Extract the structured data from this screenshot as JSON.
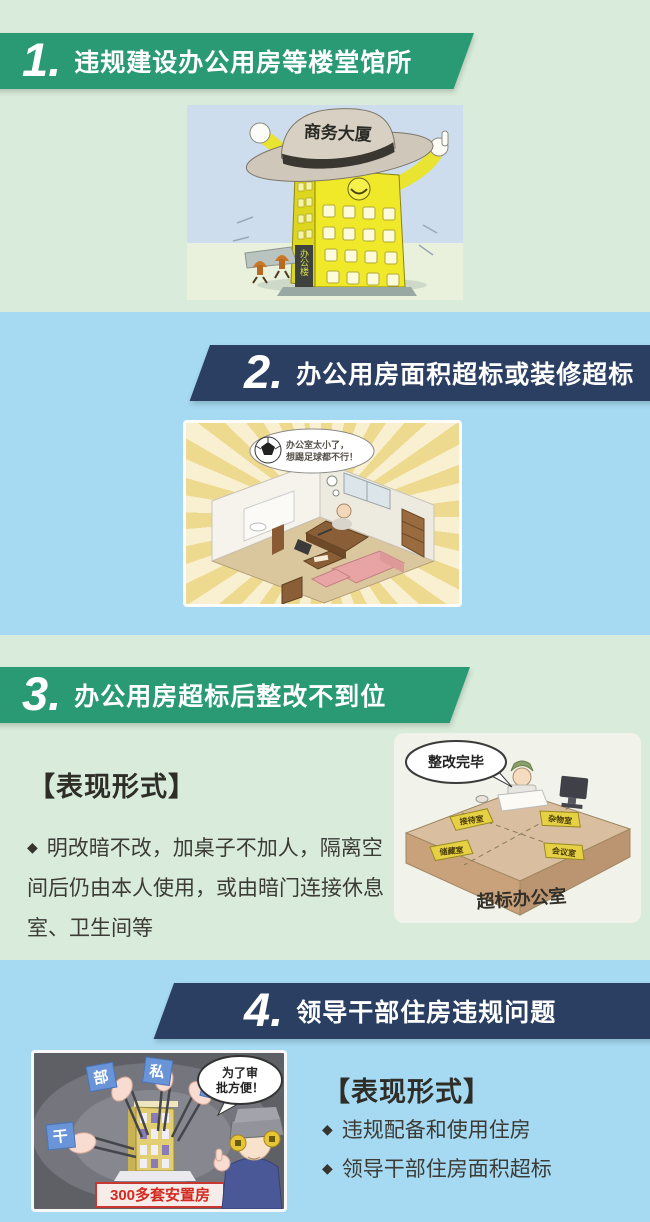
{
  "colors": {
    "banner_green": "#2a9a74",
    "banner_navy": "#2b3f63",
    "bg_green": "#d9ecdb",
    "bg_blue": "#a6daf2",
    "heading_text": "#2e2d28",
    "red_accent": "#d42a20"
  },
  "sections": [
    {
      "number": "1.",
      "title": "违规建设办公用房等楼堂馆所"
    },
    {
      "number": "2.",
      "title": "办公用房面积超标或装修超标"
    },
    {
      "number": "3.",
      "title": "办公用房超标后整改不到位"
    },
    {
      "number": "4.",
      "title": "领导干部住房违规问题"
    }
  ],
  "form3": {
    "heading": "【表现形式】",
    "bullet_icon": "◆",
    "text": "明改暗不改，加桌子不加人，隔离空间后仍由本人使用，或由暗门连接休息室、卫生间等"
  },
  "form4": {
    "heading": "【表现形式】",
    "bullet_icon": "◆",
    "items": [
      "违规配备和使用住房",
      "领导干部住房面积超标"
    ]
  },
  "illu1": {
    "hat": "商务大厦",
    "sign": "办公楼"
  },
  "illu2": {
    "bubble1": "办公室太小了，",
    "bubble2": "想踢足球都不行！"
  },
  "illu3": {
    "bubble": "整改完毕",
    "front": "超标办公室",
    "sign1": "接待室",
    "sign2": "杂物室",
    "sign3": "储藏室",
    "sign4": "会议室"
  },
  "illu4": {
    "bubble1": "为了审",
    "bubble2": "批方便！",
    "banner": "300多套安置房",
    "tag1": "干",
    "tag2": "部",
    "tag3": "私",
    "tag4": "分"
  }
}
